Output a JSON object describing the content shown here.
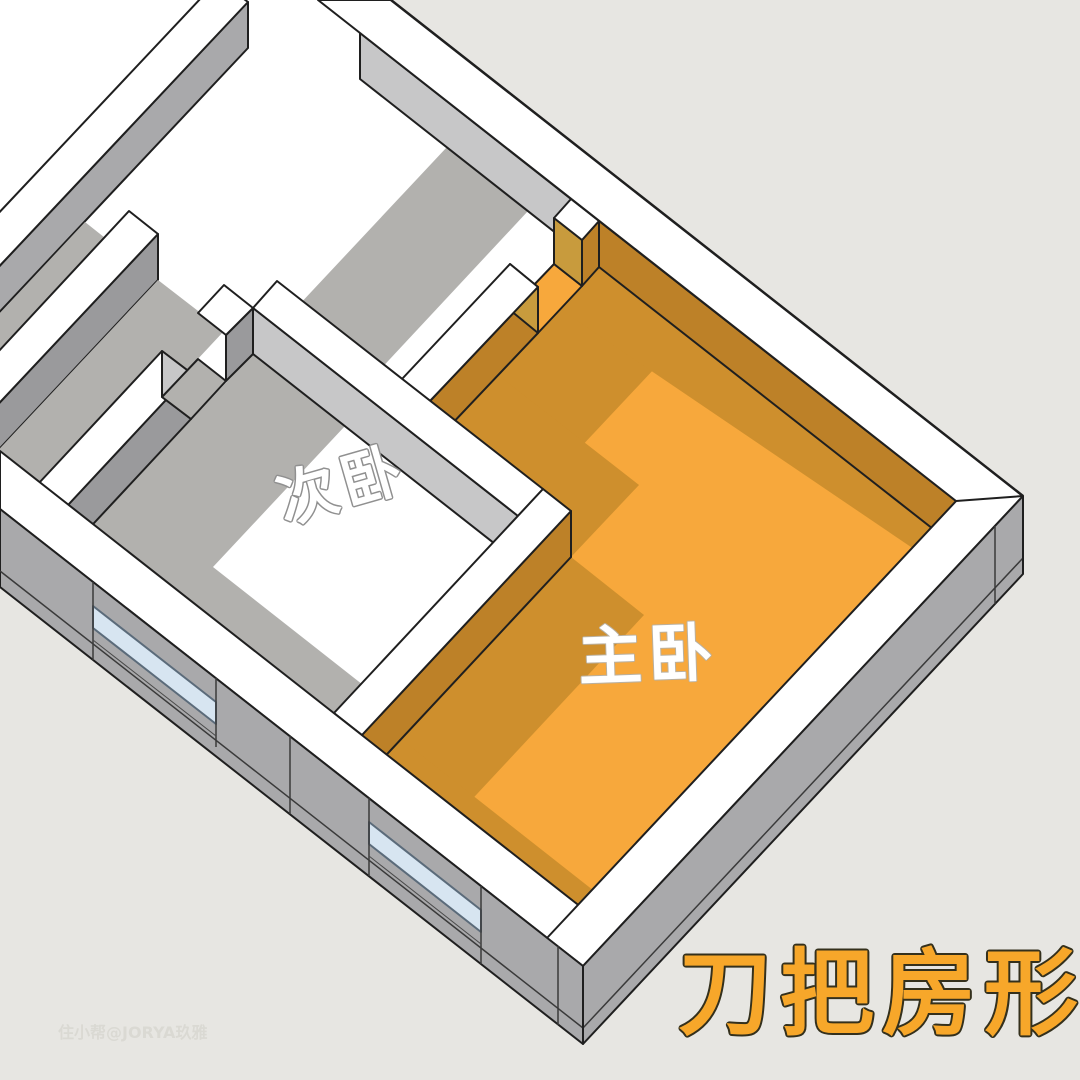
{
  "title_overlay": {
    "text": "刀把房形",
    "color": "#F7A72A",
    "outline": "#34301c",
    "x": 882,
    "y": 1026,
    "font_size": 94,
    "letter_spacing": 8,
    "rotation": 0
  },
  "watermark": {
    "text": "住小帮@JORYA玖雅",
    "color": "#d9d8d2",
    "x": 58,
    "y": 1038,
    "font_size": 16
  },
  "labels": {
    "master_bedroom": {
      "text": "主卧",
      "x": 649,
      "y": 677,
      "font_size": 64,
      "rotation": -2,
      "fill": "#ffffff",
      "outline": "#b9b0a0",
      "outline_w": 2
    },
    "secondary_bedroom": {
      "text": "次卧",
      "x": 348,
      "y": 505,
      "font_size": 60,
      "rotation": -16,
      "fill": "#ffffff",
      "outline": "#909090",
      "outline_w": 3
    }
  },
  "colors": {
    "background": "#E7E6E2",
    "plate_white": "#FFFFFF",
    "wall_gray": "#A9A9AB",
    "wall_gray_dark": "#9A9A9C",
    "inner_gray_lit": "#C7C7C8",
    "floor_shadow_gray": "#B2B1AE",
    "orange_floor": "#F7A83C",
    "orange_shadow": "#CE8F2D",
    "orange_wall_face": "#BD8128",
    "jamb_tan": "#C89B3D",
    "window_glass": "#D7E5F1",
    "window_frame": "#5B6B7A",
    "outline_dark": "#1F1F1F",
    "edge_soft": "#3A3A3A"
  },
  "scene": {
    "polygons": [
      {
        "name": "building-plate",
        "fill": "#FFFFFF",
        "stroke": "none",
        "points": [
          [
            0,
            509
          ],
          [
            583,
            966
          ],
          [
            1023,
            496
          ],
          [
            391,
            0
          ],
          [
            0,
            0
          ]
        ]
      },
      {
        "name": "far-wall-face",
        "fill": "#A9A9AB",
        "stroke": "#1F1F1F",
        "points": [
          [
            -8,
            274
          ],
          [
            248,
            2
          ],
          [
            248,
            48
          ],
          [
            -8,
            320
          ]
        ]
      },
      {
        "name": "far-wall-top",
        "fill": "#FFFFFF",
        "stroke": "#1F1F1F",
        "points": [
          [
            -38,
            252
          ],
          [
            218,
            -20
          ],
          [
            248,
            2
          ],
          [
            -8,
            274
          ]
        ]
      },
      {
        "name": "far-corridor-shadow",
        "fill": "#B2B1AE",
        "stroke": "none",
        "points": [
          [
            -55,
            455
          ],
          [
            129,
            257
          ],
          [
            85,
            222
          ],
          [
            -100,
            420
          ]
        ]
      },
      {
        "name": "corridor-wall-face",
        "fill": "#9A9A9C",
        "stroke": "#1F1F1F",
        "points": [
          [
            -27,
            431
          ],
          [
            158,
            234
          ],
          [
            158,
            280
          ],
          [
            -27,
            477
          ]
        ]
      },
      {
        "name": "corridor-wall-top",
        "fill": "#FFFFFF",
        "stroke": "#1F1F1F",
        "points": [
          [
            -55,
            409
          ],
          [
            129,
            211
          ],
          [
            158,
            234
          ],
          [
            -27,
            431
          ]
        ]
      },
      {
        "name": "outer-corridor-shadow",
        "fill": "#B2B1AE",
        "stroke": "none",
        "points": [
          [
            39,
            529
          ],
          [
            224,
            331
          ],
          [
            158,
            280
          ],
          [
            -27,
            477
          ]
        ]
      },
      {
        "name": "secondary-bedroom-shadow",
        "fill": "#B2B1AE",
        "stroke": "none",
        "points": [
          [
            334,
            759
          ],
          [
            386,
            703
          ],
          [
            213,
            567
          ],
          [
            345,
            426
          ],
          [
            253,
            354
          ],
          [
            68,
            551
          ]
        ]
      },
      {
        "name": "hallway-shadow",
        "fill": "#B2B1AE",
        "stroke": "none",
        "points": [
          [
            335,
            418
          ],
          [
            528,
            211
          ],
          [
            447,
            147
          ],
          [
            253,
            354
          ]
        ]
      },
      {
        "name": "master-bedroom-floor",
        "fill": "#F7A83C",
        "stroke": "#1F1F1F",
        "points": [
          [
            578,
            951
          ],
          [
            956,
            547
          ],
          [
            599,
            267
          ],
          [
            430,
            447
          ],
          [
            571,
            557
          ],
          [
            362,
            781
          ]
        ]
      },
      {
        "name": "master-floor-shadow-top",
        "fill": "#CE8F2D",
        "stroke": "none",
        "points": [
          [
            430,
            447
          ],
          [
            599,
            267
          ],
          [
            686,
            335
          ],
          [
            517,
            515
          ]
        ]
      },
      {
        "name": "master-floor-shadow-divider",
        "fill": "#CE8F2D",
        "stroke": "none",
        "points": [
          [
            571,
            557
          ],
          [
            430,
            447
          ],
          [
            498,
            375
          ],
          [
            639,
            485
          ]
        ]
      },
      {
        "name": "master-floor-shadow-handle-top",
        "fill": "#CE8F2D",
        "stroke": "none",
        "points": [
          [
            362,
            781
          ],
          [
            571,
            557
          ],
          [
            644,
            615
          ],
          [
            435,
            839
          ]
        ]
      },
      {
        "name": "master-floor-shadow-handle-left",
        "fill": "#CE8F2D",
        "stroke": "none",
        "points": [
          [
            578,
            951
          ],
          [
            362,
            781
          ],
          [
            401,
            739
          ],
          [
            617,
            909
          ]
        ]
      },
      {
        "name": "master-floor-shadow-right",
        "fill": "#CE8F2D",
        "stroke": "none",
        "points": [
          [
            956,
            547
          ],
          [
            599,
            267
          ],
          [
            560,
            309
          ],
          [
            939,
            566
          ]
        ]
      },
      {
        "name": "master-door-floor-patch",
        "fill": "#F7A83C",
        "stroke": "#1F1F1F",
        "points": [
          [
            538,
            333
          ],
          [
            582,
            286
          ],
          [
            554,
            264
          ],
          [
            510,
            310
          ]
        ]
      },
      {
        "name": "right-wall-inner-corridor",
        "fill": "#C7C7C8",
        "stroke": "#1F1F1F",
        "points": [
          [
            599,
            221
          ],
          [
            360,
            33
          ],
          [
            360,
            79
          ],
          [
            599,
            267
          ]
        ]
      },
      {
        "name": "right-wall-inner-master",
        "fill": "#BD8128",
        "stroke": "#1F1F1F",
        "points": [
          [
            956,
            501
          ],
          [
            599,
            221
          ],
          [
            599,
            267
          ],
          [
            956,
            547
          ]
        ]
      },
      {
        "name": "master-top-wall-face",
        "fill": "#BD8128",
        "stroke": "#1F1F1F",
        "points": [
          [
            430,
            401
          ],
          [
            538,
            287
          ],
          [
            538,
            333
          ],
          [
            430,
            447
          ]
        ]
      },
      {
        "name": "master-top-wall-jamb-face",
        "fill": "#C89B3D",
        "stroke": "#1F1F1F",
        "points": [
          [
            538,
            287
          ],
          [
            510,
            264
          ],
          [
            510,
            310
          ],
          [
            538,
            333
          ]
        ]
      },
      {
        "name": "master-top-wall-top",
        "fill": "#FFFFFF",
        "stroke": "#1F1F1F",
        "points": [
          [
            430,
            401
          ],
          [
            538,
            287
          ],
          [
            510,
            264
          ],
          [
            402,
            379
          ]
        ]
      },
      {
        "name": "master-door-stub-face",
        "fill": "#BD8128",
        "stroke": "#1F1F1F",
        "points": [
          [
            582,
            240
          ],
          [
            599,
            221
          ],
          [
            599,
            267
          ],
          [
            582,
            286
          ]
        ]
      },
      {
        "name": "master-door-stub-end",
        "fill": "#C89B3D",
        "stroke": "#1F1F1F",
        "points": [
          [
            582,
            240
          ],
          [
            554,
            218
          ],
          [
            554,
            264
          ],
          [
            582,
            286
          ]
        ]
      },
      {
        "name": "master-door-stub-top",
        "fill": "#FFFFFF",
        "stroke": "#1F1F1F",
        "points": [
          [
            582,
            240
          ],
          [
            599,
            221
          ],
          [
            571,
            199
          ],
          [
            554,
            218
          ]
        ]
      },
      {
        "name": "divider-wall-face",
        "fill": "#C7C7C8",
        "stroke": "#1F1F1F",
        "points": [
          [
            518,
            516
          ],
          [
            253,
            308
          ],
          [
            253,
            354
          ],
          [
            518,
            562
          ]
        ]
      },
      {
        "name": "divider-wall-top",
        "fill": "#FFFFFF",
        "stroke": "#1F1F1F",
        "points": [
          [
            518,
            516
          ],
          [
            543,
            489
          ],
          [
            277,
            281
          ],
          [
            253,
            308
          ]
        ]
      },
      {
        "name": "handle-top-wall-face",
        "fill": "#BD8128",
        "stroke": "#1F1F1F",
        "points": [
          [
            362,
            735
          ],
          [
            571,
            511
          ],
          [
            571,
            557
          ],
          [
            362,
            781
          ]
        ]
      },
      {
        "name": "handle-top-wall-top",
        "fill": "#FFFFFF",
        "stroke": "#1F1F1F",
        "points": [
          [
            362,
            735
          ],
          [
            571,
            511
          ],
          [
            543,
            489
          ],
          [
            334,
            713
          ]
        ]
      },
      {
        "name": "secondary-top-wall-face-left",
        "fill": "#9A9A9C",
        "stroke": "#1F1F1F",
        "points": [
          [
            68,
            505
          ],
          [
            191,
            373
          ],
          [
            191,
            419
          ],
          [
            68,
            551
          ]
        ]
      },
      {
        "name": "secondary-top-wall-top-left",
        "fill": "#FFFFFF",
        "stroke": "#1F1F1F",
        "points": [
          [
            68,
            505
          ],
          [
            191,
            373
          ],
          [
            162,
            351
          ],
          [
            39,
            483
          ]
        ]
      },
      {
        "name": "secondary-door-end-face",
        "fill": "#C7C7C8",
        "stroke": "#1F1F1F",
        "points": [
          [
            191,
            373
          ],
          [
            162,
            351
          ],
          [
            162,
            397
          ],
          [
            191,
            419
          ]
        ]
      },
      {
        "name": "secondary-door-floor-patch",
        "fill": "#B2B1AE",
        "stroke": "#1F1F1F",
        "points": [
          [
            191,
            419
          ],
          [
            226,
            381
          ],
          [
            198,
            359
          ],
          [
            162,
            397
          ]
        ]
      },
      {
        "name": "secondary-top-wall-face-right",
        "fill": "#9A9A9C",
        "stroke": "#1F1F1F",
        "points": [
          [
            226,
            335
          ],
          [
            253,
            308
          ],
          [
            253,
            354
          ],
          [
            226,
            381
          ]
        ]
      },
      {
        "name": "secondary-top-wall-top-right",
        "fill": "#FFFFFF",
        "stroke": "#1F1F1F",
        "points": [
          [
            226,
            335
          ],
          [
            253,
            308
          ],
          [
            224,
            285
          ],
          [
            198,
            313
          ]
        ]
      },
      {
        "name": "bottom-left-wall-top",
        "fill": "#FFFFFF",
        "stroke": "#1F1F1F",
        "points": [
          [
            0,
            509
          ],
          [
            583,
            966
          ],
          [
            614,
            933
          ],
          [
            0,
            451
          ]
        ]
      },
      {
        "name": "bottom-right-wall-top",
        "fill": "#FFFFFF",
        "stroke": "#1F1F1F",
        "points": [
          [
            583,
            966
          ],
          [
            1023,
            496
          ],
          [
            987,
            468
          ],
          [
            547,
            938
          ]
        ]
      },
      {
        "name": "top-right-wall-top",
        "fill": "#FFFFFF",
        "stroke": "#1F1F1F",
        "points": [
          [
            1023,
            496
          ],
          [
            391,
            0
          ],
          [
            318,
            0
          ],
          [
            956,
            501
          ]
        ]
      },
      {
        "name": "bottom-left-wall-exterior",
        "fill": "#A9A9AB",
        "stroke": "#1F1F1F",
        "points": [
          [
            0,
            509
          ],
          [
            583,
            966
          ],
          [
            583,
            1044
          ],
          [
            0,
            587
          ]
        ]
      },
      {
        "name": "bottom-right-wall-exterior",
        "fill": "#A9A9AB",
        "stroke": "#1F1F1F",
        "points": [
          [
            583,
            966
          ],
          [
            1023,
            496
          ],
          [
            1023,
            574
          ],
          [
            583,
            1044
          ]
        ]
      },
      {
        "name": "window-1-glass",
        "fill": "#D7E5F1",
        "stroke": "#5B6B7A",
        "points": [
          [
            93,
            606
          ],
          [
            216,
            702
          ],
          [
            216,
            724
          ],
          [
            93,
            628
          ]
        ]
      },
      {
        "name": "window-2-glass",
        "fill": "#D7E5F1",
        "stroke": "#5B6B7A",
        "points": [
          [
            369,
            822
          ],
          [
            481,
            910
          ],
          [
            481,
            932
          ],
          [
            369,
            844
          ]
        ]
      }
    ],
    "lines": [
      {
        "name": "slab-line-left",
        "x1": 0,
        "y1": 571,
        "x2": 583,
        "y2": 1028,
        "stroke": "#3A3A3A",
        "w": 1.5
      },
      {
        "name": "slab-line-right",
        "x1": 583,
        "y1": 1028,
        "x2": 1023,
        "y2": 558,
        "stroke": "#3A3A3A",
        "w": 1.5
      },
      {
        "name": "joint-w1-left",
        "x1": 93,
        "y1": 582,
        "x2": 93,
        "y2": 660,
        "stroke": "#3A3A3A",
        "w": 1.5
      },
      {
        "name": "joint-w1-right",
        "x1": 216,
        "y1": 678,
        "x2": 216,
        "y2": 747,
        "stroke": "#3A3A3A",
        "w": 1.5
      },
      {
        "name": "joint-pier",
        "x1": 290,
        "y1": 736,
        "x2": 290,
        "y2": 814,
        "stroke": "#3A3A3A",
        "w": 1.5
      },
      {
        "name": "joint-w2-left",
        "x1": 369,
        "y1": 798,
        "x2": 369,
        "y2": 876,
        "stroke": "#3A3A3A",
        "w": 1.5
      },
      {
        "name": "joint-w2-right",
        "x1": 481,
        "y1": 886,
        "x2": 481,
        "y2": 964,
        "stroke": "#3A3A3A",
        "w": 1.5
      },
      {
        "name": "joint-corner-left",
        "x1": 558,
        "y1": 946,
        "x2": 558,
        "y2": 1025,
        "stroke": "#3A3A3A",
        "w": 1.5
      },
      {
        "name": "joint-corner-right",
        "x1": 995,
        "y1": 526,
        "x2": 995,
        "y2": 604,
        "stroke": "#3A3A3A",
        "w": 1.5
      },
      {
        "name": "sill-w1",
        "x1": 93,
        "y1": 640,
        "x2": 216,
        "y2": 736,
        "stroke": "#4A4A4A",
        "w": 1
      },
      {
        "name": "sill-w2",
        "x1": 369,
        "y1": 856,
        "x2": 481,
        "y2": 944,
        "stroke": "#4A4A4A",
        "w": 1
      },
      {
        "name": "edge-corner-b",
        "x1": 583,
        "y1": 966,
        "x2": 583,
        "y2": 1044,
        "stroke": "#1F1F1F",
        "w": 2
      },
      {
        "name": "edge-corner-r",
        "x1": 1023,
        "y1": 496,
        "x2": 1023,
        "y2": 574,
        "stroke": "#1F1F1F",
        "w": 2
      },
      {
        "name": "edge-outer-top-right",
        "x1": 1023,
        "y1": 496,
        "x2": 391,
        "y2": 0,
        "stroke": "#1F1F1F",
        "w": 2.5
      }
    ]
  }
}
